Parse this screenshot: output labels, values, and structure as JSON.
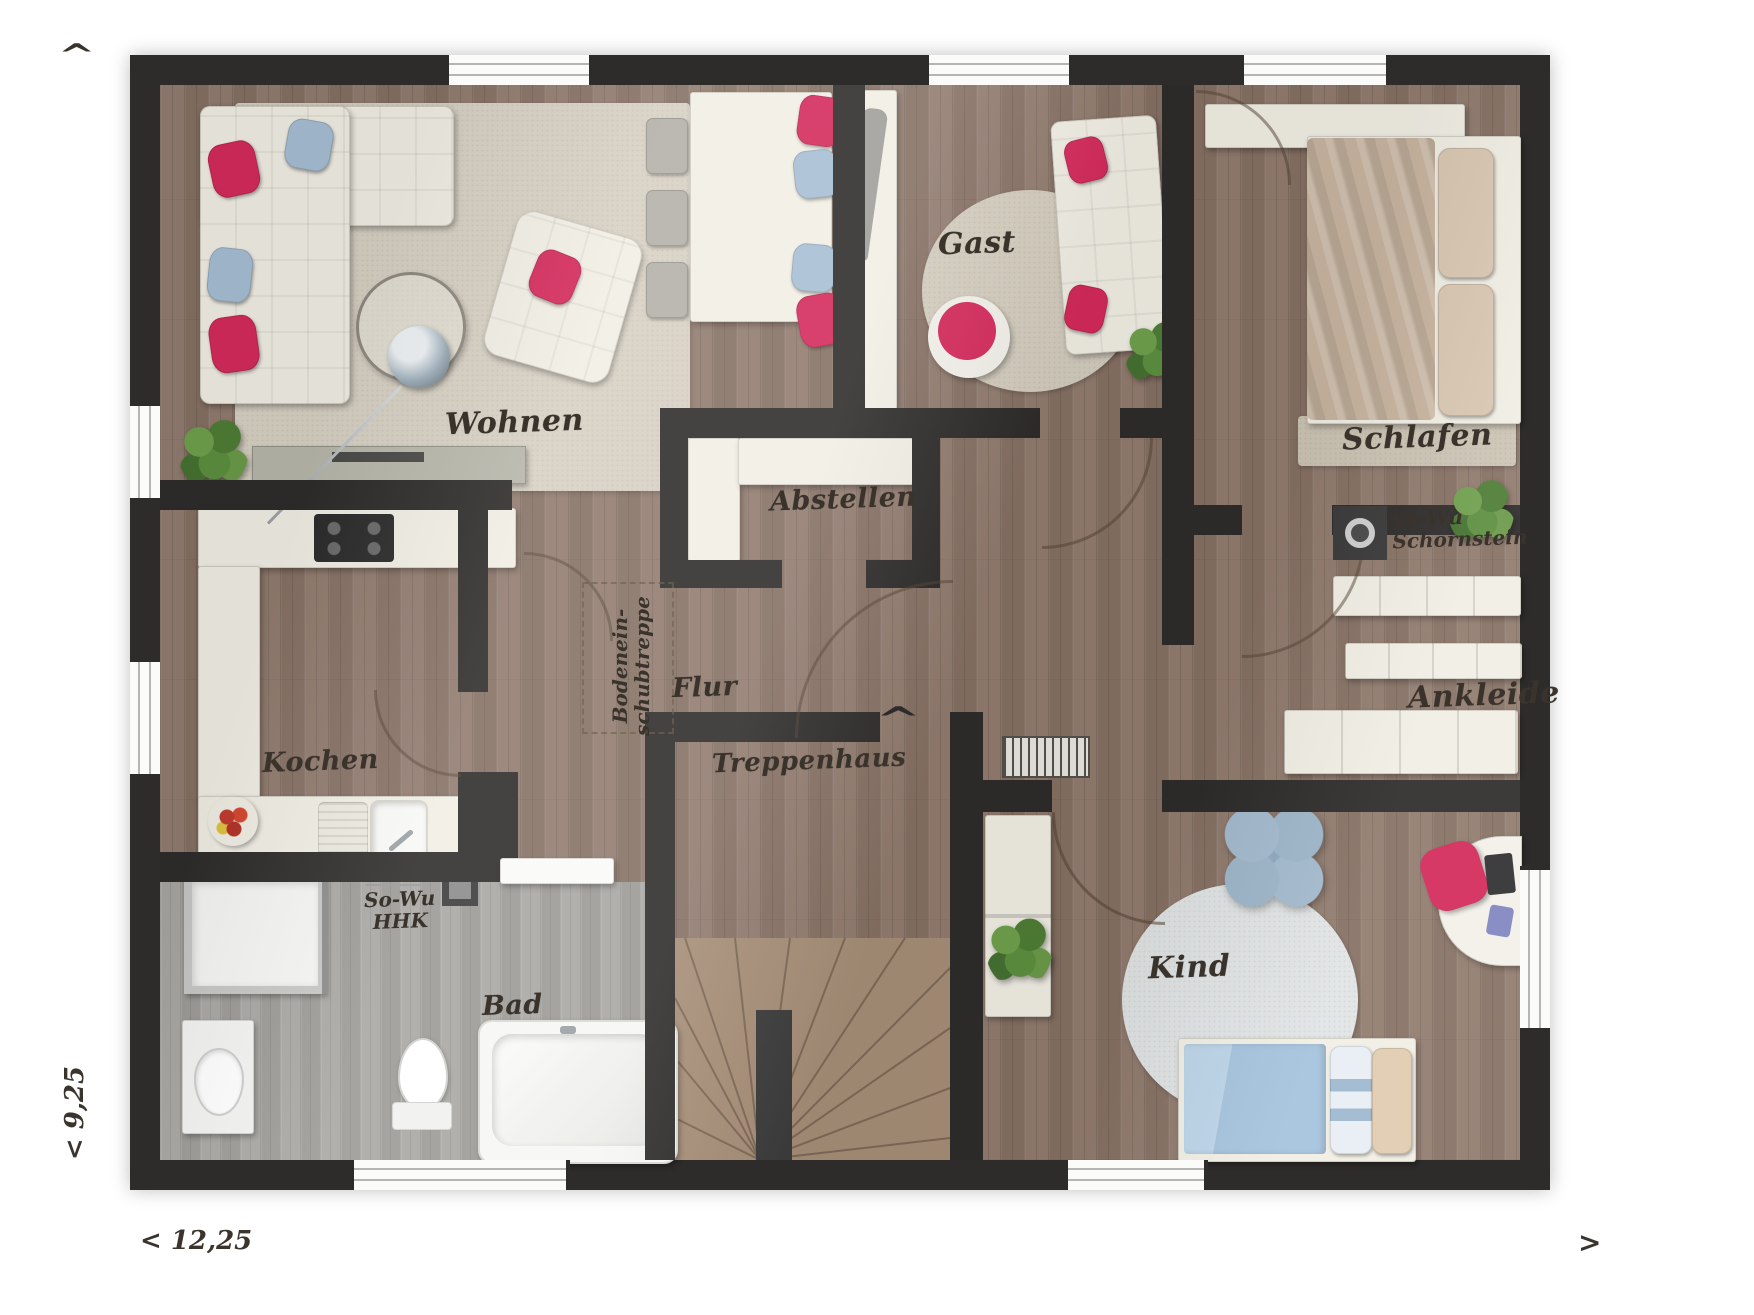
{
  "rooms": [
    {
      "id": "wohnen",
      "label": "Wohnen"
    },
    {
      "id": "gast",
      "label": "Gast"
    },
    {
      "id": "schlafen",
      "label": "Schlafen"
    },
    {
      "id": "abstellen",
      "label": "Abstellen"
    },
    {
      "id": "kochen",
      "label": "Kochen"
    },
    {
      "id": "flur",
      "label": "Flur"
    },
    {
      "id": "treppenhaus",
      "label": "Treppenhaus"
    },
    {
      "id": "ankleide",
      "label": "Ankleide"
    },
    {
      "id": "kind",
      "label": "Kind"
    },
    {
      "id": "bad",
      "label": "Bad"
    }
  ],
  "annotations": {
    "schornstein": {
      "line1": "So-Wu",
      "line2": "Schornstein"
    },
    "hhk": {
      "line1": "So-Wu",
      "line2": "HHK"
    },
    "bodentreppe": {
      "line1": "Bodenein-",
      "line2": "schubtreppe"
    }
  },
  "dimensions": {
    "width_label": "< 12,25",
    "height_label": "< 9,25",
    "arrow_up_glyph": "^",
    "arrow_right_glyph": ">",
    "stair_direction_glyph": "^"
  },
  "colors": {
    "wall": "#2e2c2a",
    "wood_floor": "#8d7668",
    "bath_floor": "#a3a19d",
    "accent_red": "#d42a5b",
    "accent_blue": "#a7bed3",
    "furniture_cream": "#f1eee4"
  }
}
